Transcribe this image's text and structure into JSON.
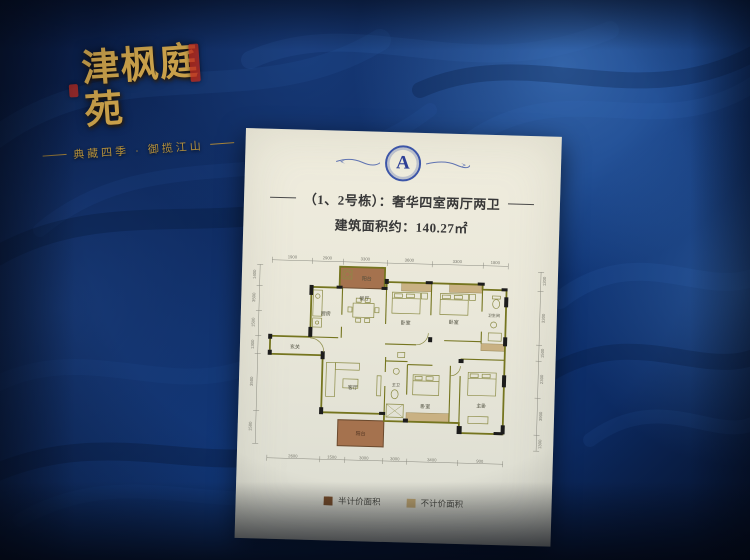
{
  "branding": {
    "title": "津枫庭苑",
    "tagline": "典藏四季 · 御揽江山"
  },
  "poster": {
    "emblem_letter": "A",
    "unit_title": "（1、2号栋）：奢华四室两厅两卫",
    "area_text": "建筑面积约：140.27㎡",
    "legend": [
      {
        "label": "半计价面积",
        "color": "#7a4f2b"
      },
      {
        "label": "不计价面积",
        "color": "#c4aa74"
      }
    ]
  },
  "floorplan": {
    "rooms": {
      "kitchen": "厨房",
      "dining": "餐厅",
      "living": "客厅",
      "bedroom": "卧室",
      "master": "主卧",
      "bath": "卫生间",
      "master_bath": "主卫",
      "entry": "玄关",
      "balcony": "阳台"
    },
    "dims": {
      "top": [
        "1900",
        "2900",
        "3300",
        "3600",
        "3300",
        "1800"
      ],
      "bottom": [
        "2600",
        "1500",
        "3000",
        "3000",
        "3400",
        "900"
      ],
      "left": [
        "1400",
        "3500",
        "1500",
        "1300",
        "3500",
        "1500"
      ],
      "right": [
        "1200",
        "3300",
        "1500",
        "2300",
        "3900",
        "1300"
      ]
    }
  },
  "colors": {
    "wall_blue": "#0e2a60",
    "gold": "#c9a04a",
    "balcony_brown": "#a5724e",
    "closet_tan": "#c9b183",
    "plan_wall": "#75751f",
    "emblem_blue": "#3c55a8"
  }
}
